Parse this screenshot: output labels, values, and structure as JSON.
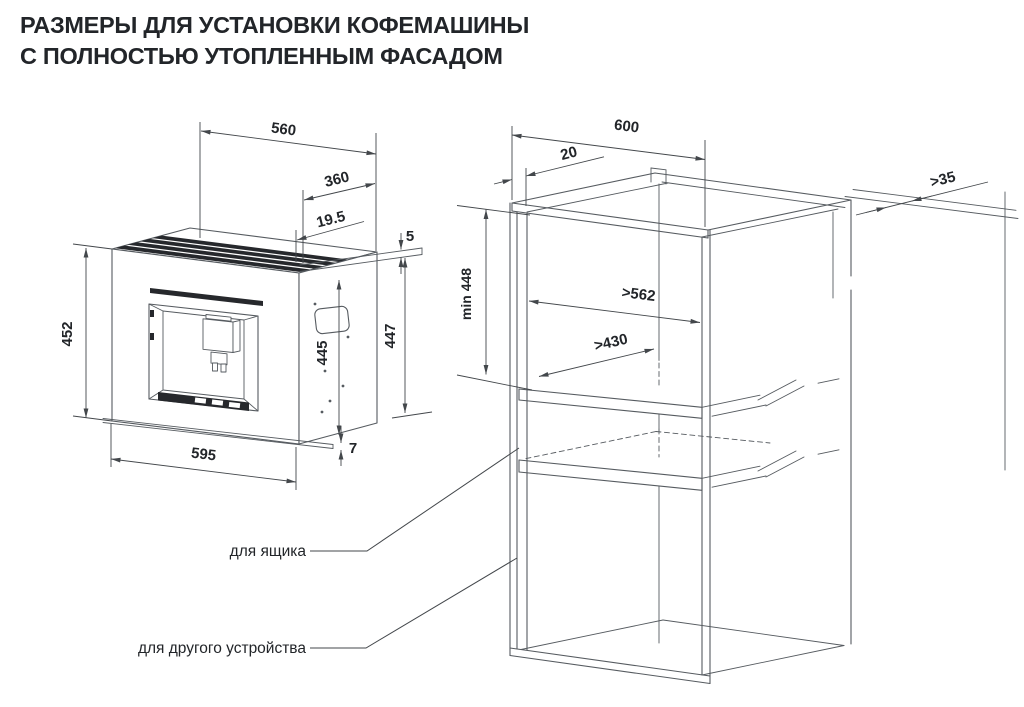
{
  "title": {
    "line1": "РАЗМЕРЫ ДЛЯ УСТАНОВКИ КОФЕМАШИНЫ",
    "line2": "С ПОЛНОСТЬЮ УТОПЛЕННЫМ ФАСАДОМ"
  },
  "machine": {
    "dims": {
      "top_width": "560",
      "top_depth": "360",
      "rail_offset": "19.5",
      "top_gap": "5",
      "facade_height": "452",
      "body_height": "445",
      "side_height": "447",
      "facade_width": "595",
      "bottom_lip": "7"
    }
  },
  "cabinet": {
    "dims": {
      "outer_width": "600",
      "front_offset": "20",
      "rear_gap": ">35",
      "niche_height": "min 448",
      "inner_width": ">562",
      "inner_depth": ">430"
    },
    "labels": {
      "drawer": "для ящика",
      "other_device": "для другого устройства"
    }
  },
  "colors": {
    "structure_line": "#565b60",
    "dimension_line": "#43474b",
    "text": "#222529",
    "dark_fill": "#26282c",
    "background": "#ffffff"
  }
}
